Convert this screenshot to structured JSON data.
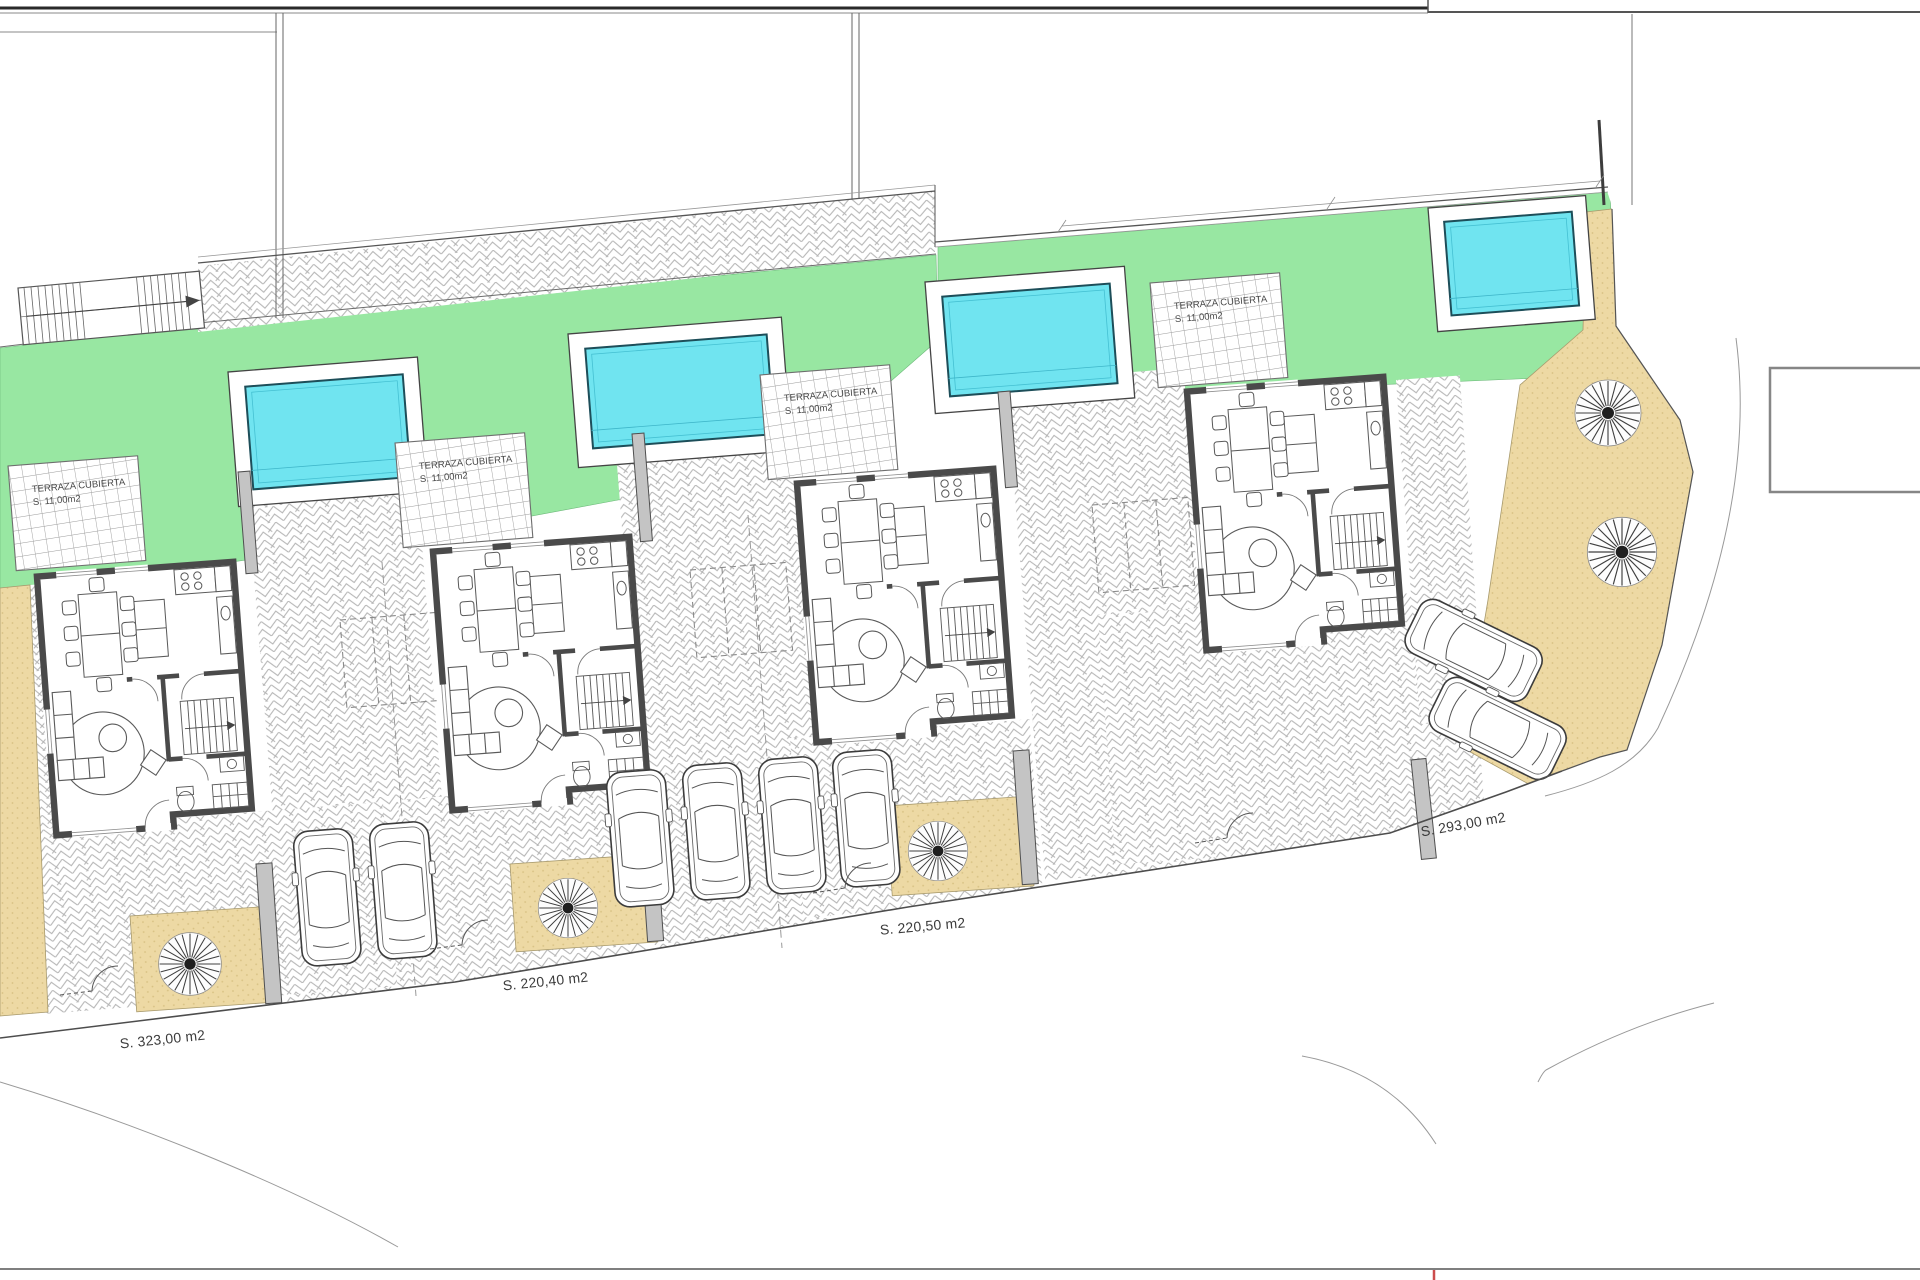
{
  "drawing": {
    "kind": "residential site plan with four detached villas, pools, gardens, terraces and parking",
    "plots": [
      {
        "id": "plot-1",
        "terrace_line1": "TERRAZA CUBIERTA",
        "terrace_line2": "S. 11,00m2",
        "area_label": "S. 323,00 m2",
        "features": {
          "pool": 1,
          "cars": 2,
          "trees": 1
        }
      },
      {
        "id": "plot-2",
        "terrace_line1": "TERRAZA CUBIERTA",
        "terrace_line2": "S. 11,00m2",
        "area_label": "S. 220,40 m2",
        "features": {
          "pool": 1,
          "cars": 2,
          "trees": 1
        }
      },
      {
        "id": "plot-3",
        "terrace_line1": "TERRAZA CUBIERTA",
        "terrace_line2": "S. 11,00m2",
        "area_label": "S. 220,50 m2",
        "features": {
          "pool": 1,
          "cars": 2,
          "trees": 1
        }
      },
      {
        "id": "plot-4",
        "terrace_line1": "TERRAZA CUBIERTA",
        "terrace_line2": "S. 11,00m2",
        "area_label": "S. 293,00 m2",
        "features": {
          "pool": 1,
          "cars": 2,
          "trees": 2
        }
      }
    ],
    "colors": {
      "grass": "#98E7A2",
      "pool_water": "#70E4F0",
      "pool_edge": "#1d4e59",
      "sand": "#EDD9A4",
      "sand_dot": "#D8C183",
      "wall": "#4a4a4a",
      "paving_line": "#b3b3b3",
      "boundary": "#4d4d4d",
      "label_text": "#3b3b3b",
      "road_mark_red": "#cc4d4d"
    }
  }
}
